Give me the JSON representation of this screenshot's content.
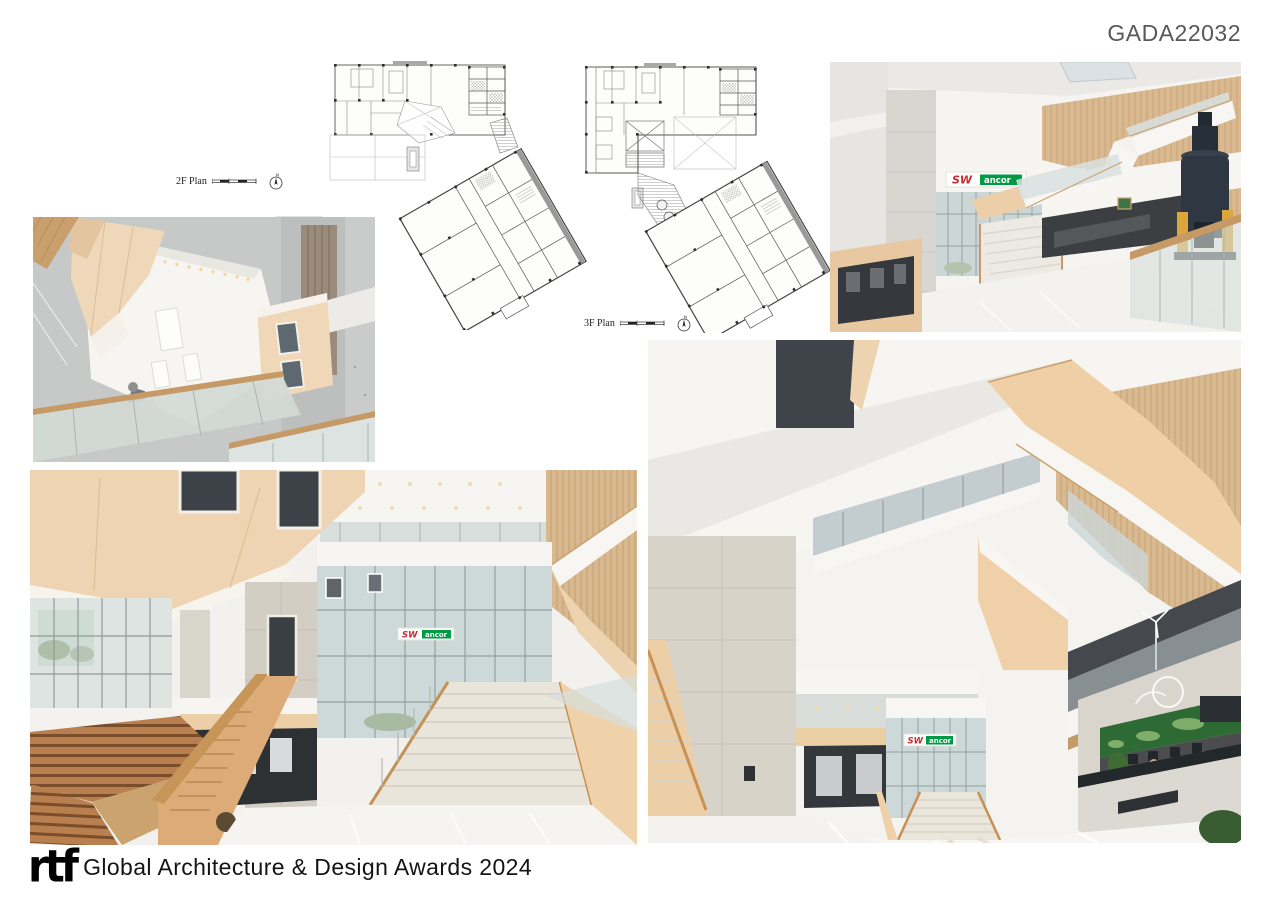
{
  "page": {
    "code": "GADA22032",
    "background": "#ffffff",
    "code_color": "#58585a"
  },
  "plans": {
    "first": {
      "label": "2F Plan",
      "north": "N"
    },
    "second": {
      "label": "3F Plan",
      "north": "N"
    }
  },
  "signage": {
    "prefix": "SW",
    "suffix": "ancor",
    "prefix_color": "#c62b2e",
    "suffix_bg": "#009a44",
    "suffix_text_color": "#ffffff"
  },
  "photos": {
    "atrium_looking_up": "interior photo looking up through atrium void to skylit ceiling",
    "atrium_stair_exhibit": "atrium with folded staircase, wood wall and navy industrial vessel exhibit",
    "grand_stair_hall": "triple-height hall with grand stair, timber bleachers and glass curtain wall",
    "lobby_reception": "lobby atrium with grand stair, peach stair volumes and reception desk"
  },
  "palette": {
    "wood": "#d9b991",
    "peach": "#eed3b0",
    "stone": "#d6d3cb",
    "glass": "#ccd6d6",
    "floor": "#f4f3f0",
    "vessel_navy": "#2e3742",
    "vessel_yellow": "#dda63c",
    "mural_green": "#2e6b34"
  },
  "footer": {
    "logo": "rtf",
    "title": "Global Architecture & Design Awards 2024"
  }
}
